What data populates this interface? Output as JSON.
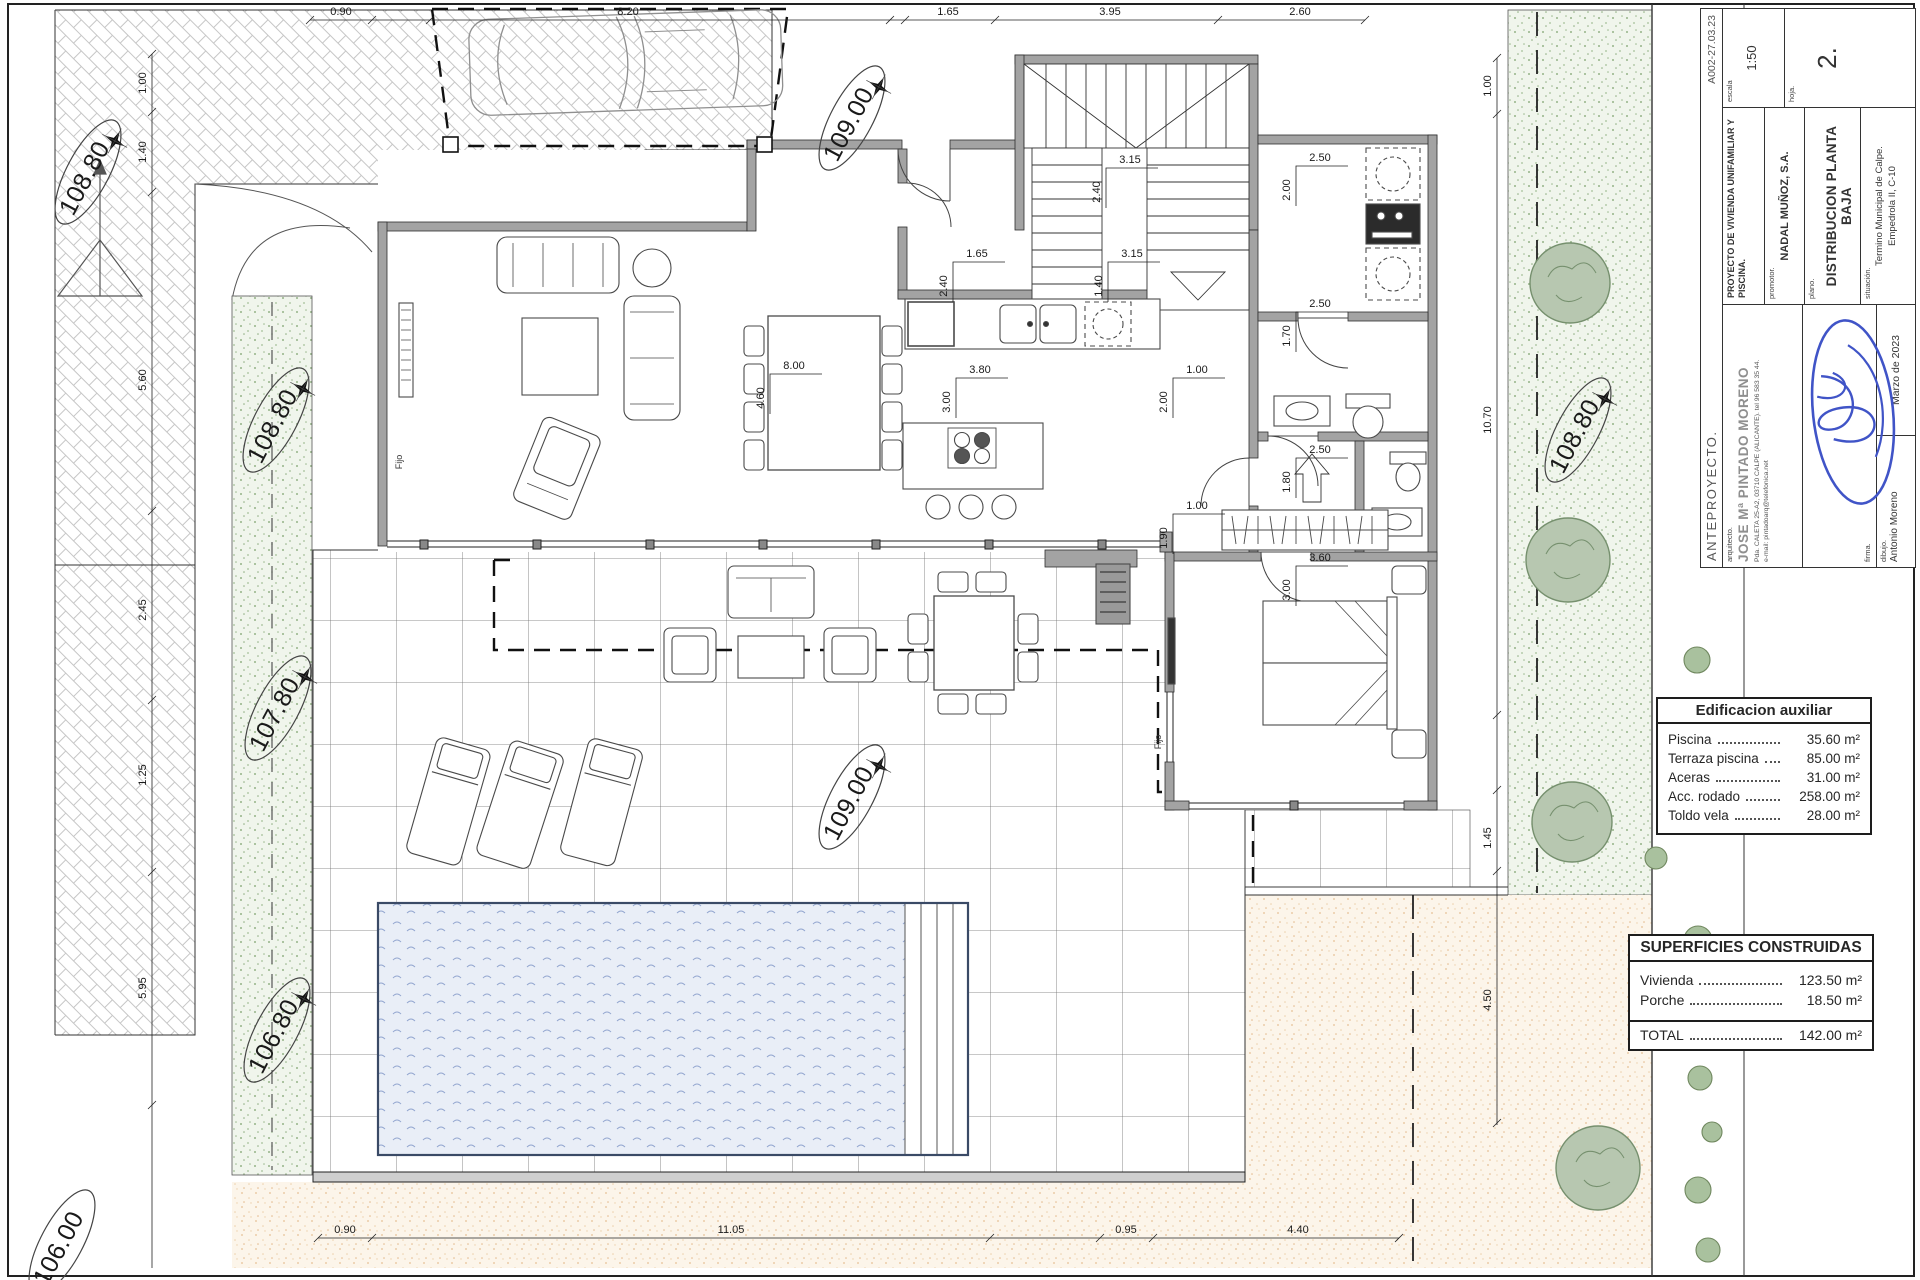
{
  "title_block": {
    "phase": "ANTEPROYECTO.",
    "code": "A002-27.03.23",
    "arquitecto_label": "arquitecto.",
    "arquitecto_name": "JOSE Mª PINTADO MORENO",
    "arquitecto_addr": "Pda. CALETA 25-A2, 03710 CALPE (ALICANTE). tel 96 583 35 44.",
    "arquitecto_email": "e-mail: pintadoarq@telefonica.net",
    "firma_label": "firma.",
    "dibujo_label": "dibujo.",
    "dibujo_value": "Antonio Moreno",
    "fecha": "Marzo de 2023",
    "proyecto": "PROYECTO DE VIVIENDA UNIFAMILIAR Y PISCINA.",
    "promotor_label": "promotor.",
    "promotor_value": "NADAL MUÑOZ, S.A.",
    "plano_label": "plano.",
    "plano_value": "DISTRIBUCION PLANTA BAJA",
    "situacion_label": "situación.",
    "situacion_value": "Termino Municipal de Calpe.",
    "situacion_value2": "Empedrola II, C-10",
    "escala_label": "escala",
    "escala_value": "1:50",
    "hoja_label": "hoja.",
    "hoja_value": "2."
  },
  "aux_table": {
    "title": "Edificacion auxiliar",
    "rows": [
      {
        "label": "Piscina",
        "value": "35.60 m²"
      },
      {
        "label": "Terraza piscina",
        "value": "85.00 m²"
      },
      {
        "label": "Aceras",
        "value": "31.00 m²"
      },
      {
        "label": "Acc. rodado",
        "value": "258.00 m²"
      },
      {
        "label": "Toldo vela",
        "value": "28.00 m²"
      }
    ]
  },
  "built_table": {
    "title": "SUPERFICIES CONSTRUIDAS",
    "rows": [
      {
        "label": "Vivienda",
        "value": "123.50 m²"
      },
      {
        "label": "Porche",
        "value": "18.50 m²"
      }
    ],
    "total_label": "TOTAL",
    "total_value": "142.00 m²"
  },
  "levels": {
    "l1": "108.80",
    "l2": "109.00",
    "l3": "108.80",
    "l4": "107.80",
    "l5": "106.80",
    "l6": "106.00",
    "l7": "109.00",
    "l8": "108.80"
  },
  "dims": {
    "t1": "0.90",
    "t2": "8.20",
    "t3": "1.65",
    "t4": "3.95",
    "t5": "2.60",
    "b1": "0.90",
    "b2": "11.05",
    "b3": "0.95",
    "b4": "4.40",
    "lc1": "1.00",
    "lc2": "1.40",
    "lc3": "5.60",
    "lc4": "2.45",
    "lc5": "1.25",
    "lc6": "5.95",
    "rc1": "1.00",
    "rc2": "10.70",
    "rc3": "1.45",
    "rc4": "4.50",
    "p1a": "3.15",
    "p1b": "2.40",
    "p2a": "1.65",
    "p2b": "2.40",
    "p3a": "3.15",
    "p3b": "1.40",
    "p4a": "3.80",
    "p4b": "3.00",
    "p5a": "1.00",
    "p5b": "2.00",
    "p6a": "2.50",
    "p6b": "2.00",
    "p7a": "2.50",
    "p7b": "1.70",
    "p8a": "2.50",
    "p8b": "1.80",
    "p9a": "1.00",
    "p9b": "1.90",
    "p10a": "3.60",
    "p10b": "3.00",
    "p11a": "8.00",
    "p11b": "4.60"
  },
  "labels": {
    "fijo1": "Fijo",
    "fijo2": "Fijo"
  }
}
